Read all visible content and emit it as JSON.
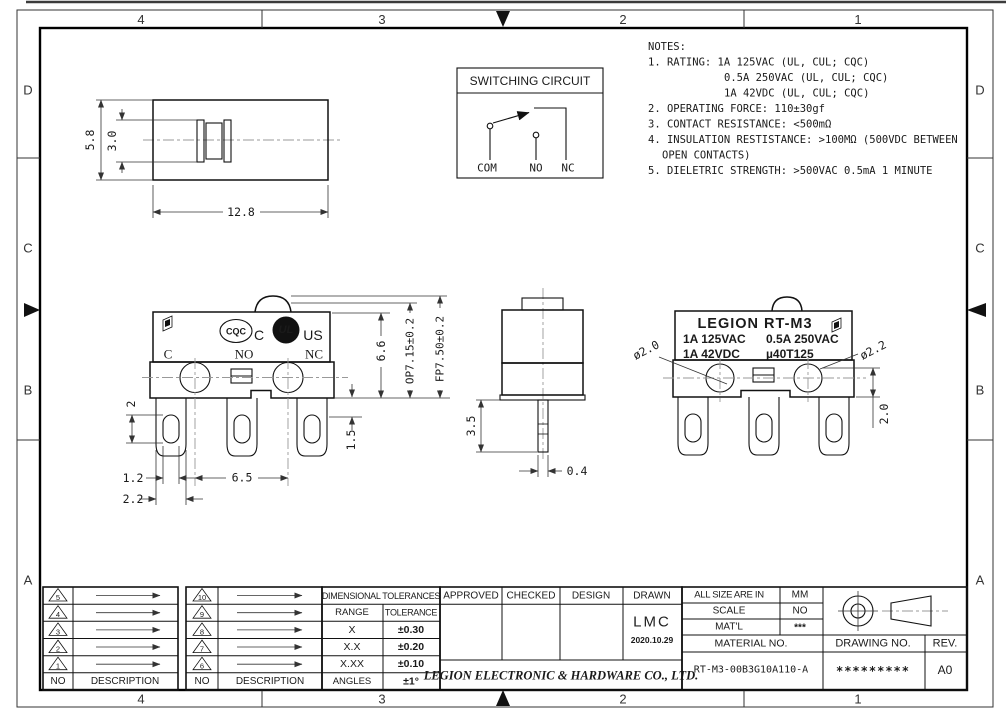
{
  "zones": {
    "cols": [
      "4",
      "3",
      "2",
      "1"
    ],
    "rows": [
      "D",
      "C",
      "B",
      "A"
    ]
  },
  "notes": {
    "title": "NOTES:",
    "lines": [
      "1. RATING: 1A 125VAC (UL, CUL; CQC)",
      "0.5A 250VAC (UL, CUL; CQC)",
      "1A 42VDC (UL, CUL; CQC)",
      "2. OPERATING FORCE: 110±30gf",
      "3. CONTACT RESISTANCE: <500mΩ",
      "4. INSULATION RESTISTANCE: >100MΩ (500VDC BETWEEN",
      "OPEN CONTACTS)",
      "5. DIELETRIC STRENGTH: >500VAC 0.5mA 1 MINUTE"
    ]
  },
  "circuit": {
    "title": "SWITCHING CIRCUIT",
    "com": "COM",
    "no": "NO",
    "nc": "NC"
  },
  "top_view": {
    "dim_height": "5.8",
    "dim_button": "3.0",
    "dim_width": "12.8"
  },
  "front_view": {
    "mark_cqc": "CQC",
    "mark_c": "C",
    "mark_ul": "UL",
    "mark_us": "US",
    "label_c": "C",
    "label_no": "NO",
    "label_nc": "NC",
    "dim_hole_h": "2",
    "dim_hole_w": "1.2",
    "dim_pitch": "6.5",
    "dim_term_w": "2.2",
    "dim_lip": "1.5",
    "dim_body_h": "6.6",
    "dim_op": "OP7.15±0.2",
    "dim_fp": "FP7.50±0.2"
  },
  "side_view": {
    "dim_pin_len": "3.5",
    "dim_pin_w": "0.4"
  },
  "back_view": {
    "mark_title": "LEGION RT-M3",
    "mark_r1a": "1A 125VAC",
    "mark_r1b": "0.5A 250VAC",
    "mark_r2a": "1A 42VDC",
    "mark_r2b": "µ40T125",
    "dim_hole_left": "ø2.0",
    "dim_hole_right": "ø2.2",
    "dim_offset": "2.0"
  },
  "revisions": {
    "no_label": "NO",
    "desc_label": "DESCRIPTION",
    "left": [
      "5",
      "4",
      "3",
      "2",
      "1"
    ],
    "right": [
      "10",
      "9",
      "8",
      "7",
      "6"
    ]
  },
  "tolerances": {
    "title": "DIMENSIONAL TOLERANCES",
    "col_range": "RANGE",
    "col_tol": "TOLERANCE",
    "rows": [
      [
        "X",
        "±0.30"
      ],
      [
        "X.X",
        "±0.20"
      ],
      [
        "X.XX",
        "±0.10"
      ],
      [
        "ANGLES",
        "±1°"
      ]
    ]
  },
  "title_block": {
    "approved": "APPROVED",
    "checked": "CHECKED",
    "design": "DESIGN",
    "drawn": "DRAWN",
    "drawn_by": "LMC",
    "drawn_date": "2020.10.29",
    "company": "LEGION ELECTRONIC & HARDWARE CO., LTD.",
    "size_label": "ALL SIZE ARE IN",
    "size_unit": "MM",
    "scale_label": "SCALE",
    "scale_value": "NO",
    "matl_label": "MAT'L",
    "matl_value": "***",
    "material_no_label": "MATERIAL NO.",
    "material_no_value": "RT-M3-00B3G10A110-A",
    "drawing_no_label": "DRAWING NO.",
    "drawing_no_value": "*********",
    "rev_label": "REV.",
    "rev_value": "A0"
  }
}
